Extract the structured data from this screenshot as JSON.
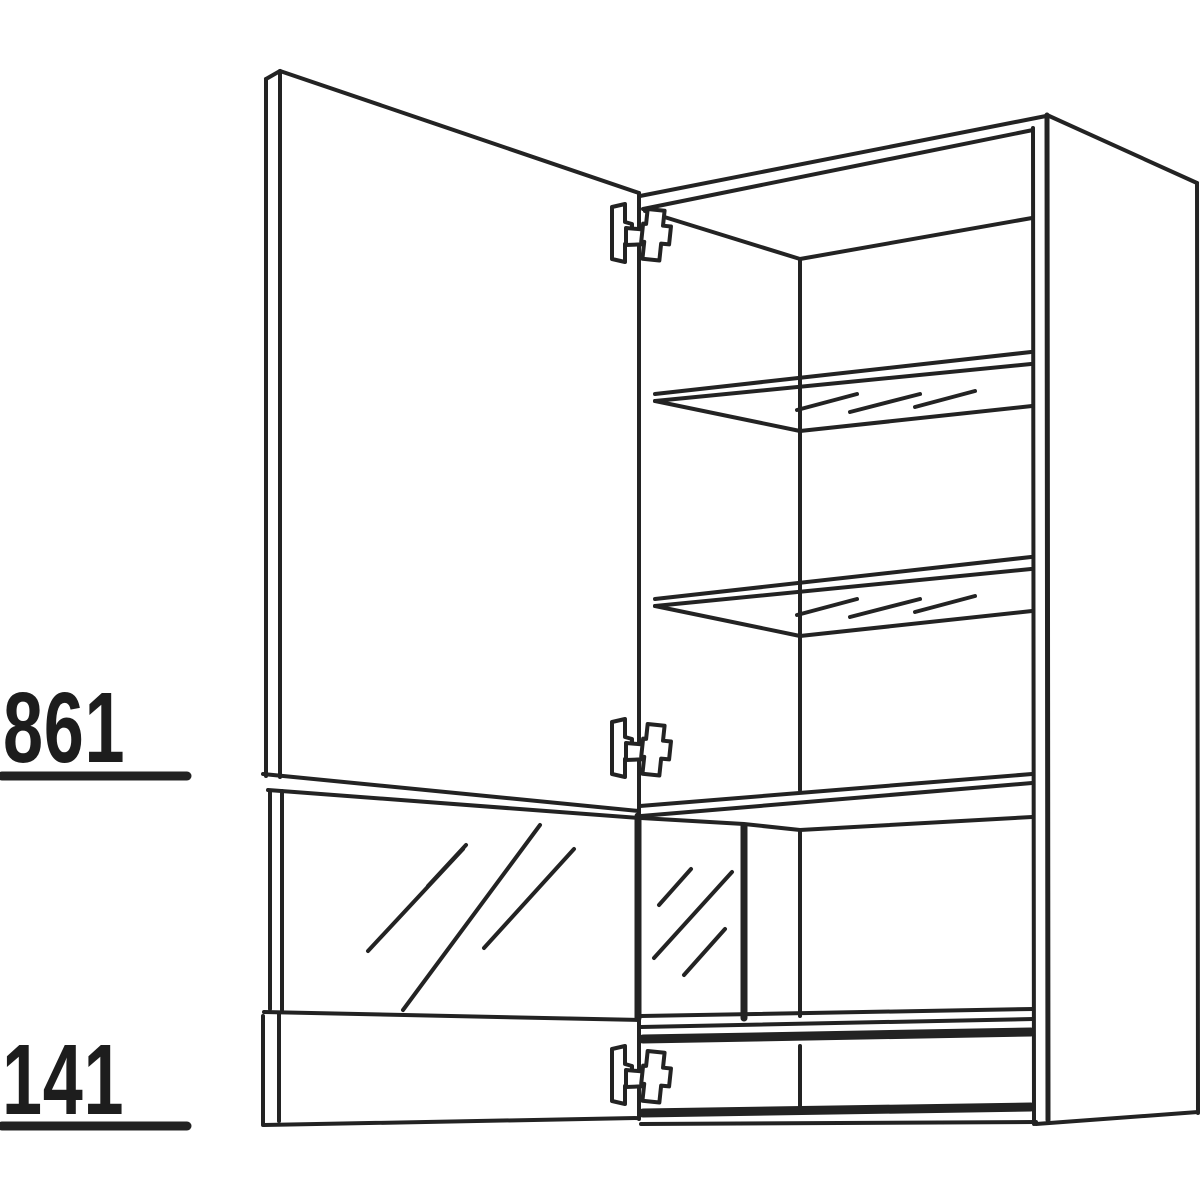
{
  "page": {
    "background": "#ffffff"
  },
  "drawing": {
    "type": "technical-line-drawing",
    "subject": "wall cabinet with open hinged door, glass door panel, two glass shelves, glass-front bottom compartment and three mounting hinges",
    "line_color": "#232323",
    "glass_shelf_count": 2,
    "hinge_count": 3
  },
  "dimensions": {
    "upper": {
      "value": "861"
    },
    "lower": {
      "value": "141"
    }
  }
}
